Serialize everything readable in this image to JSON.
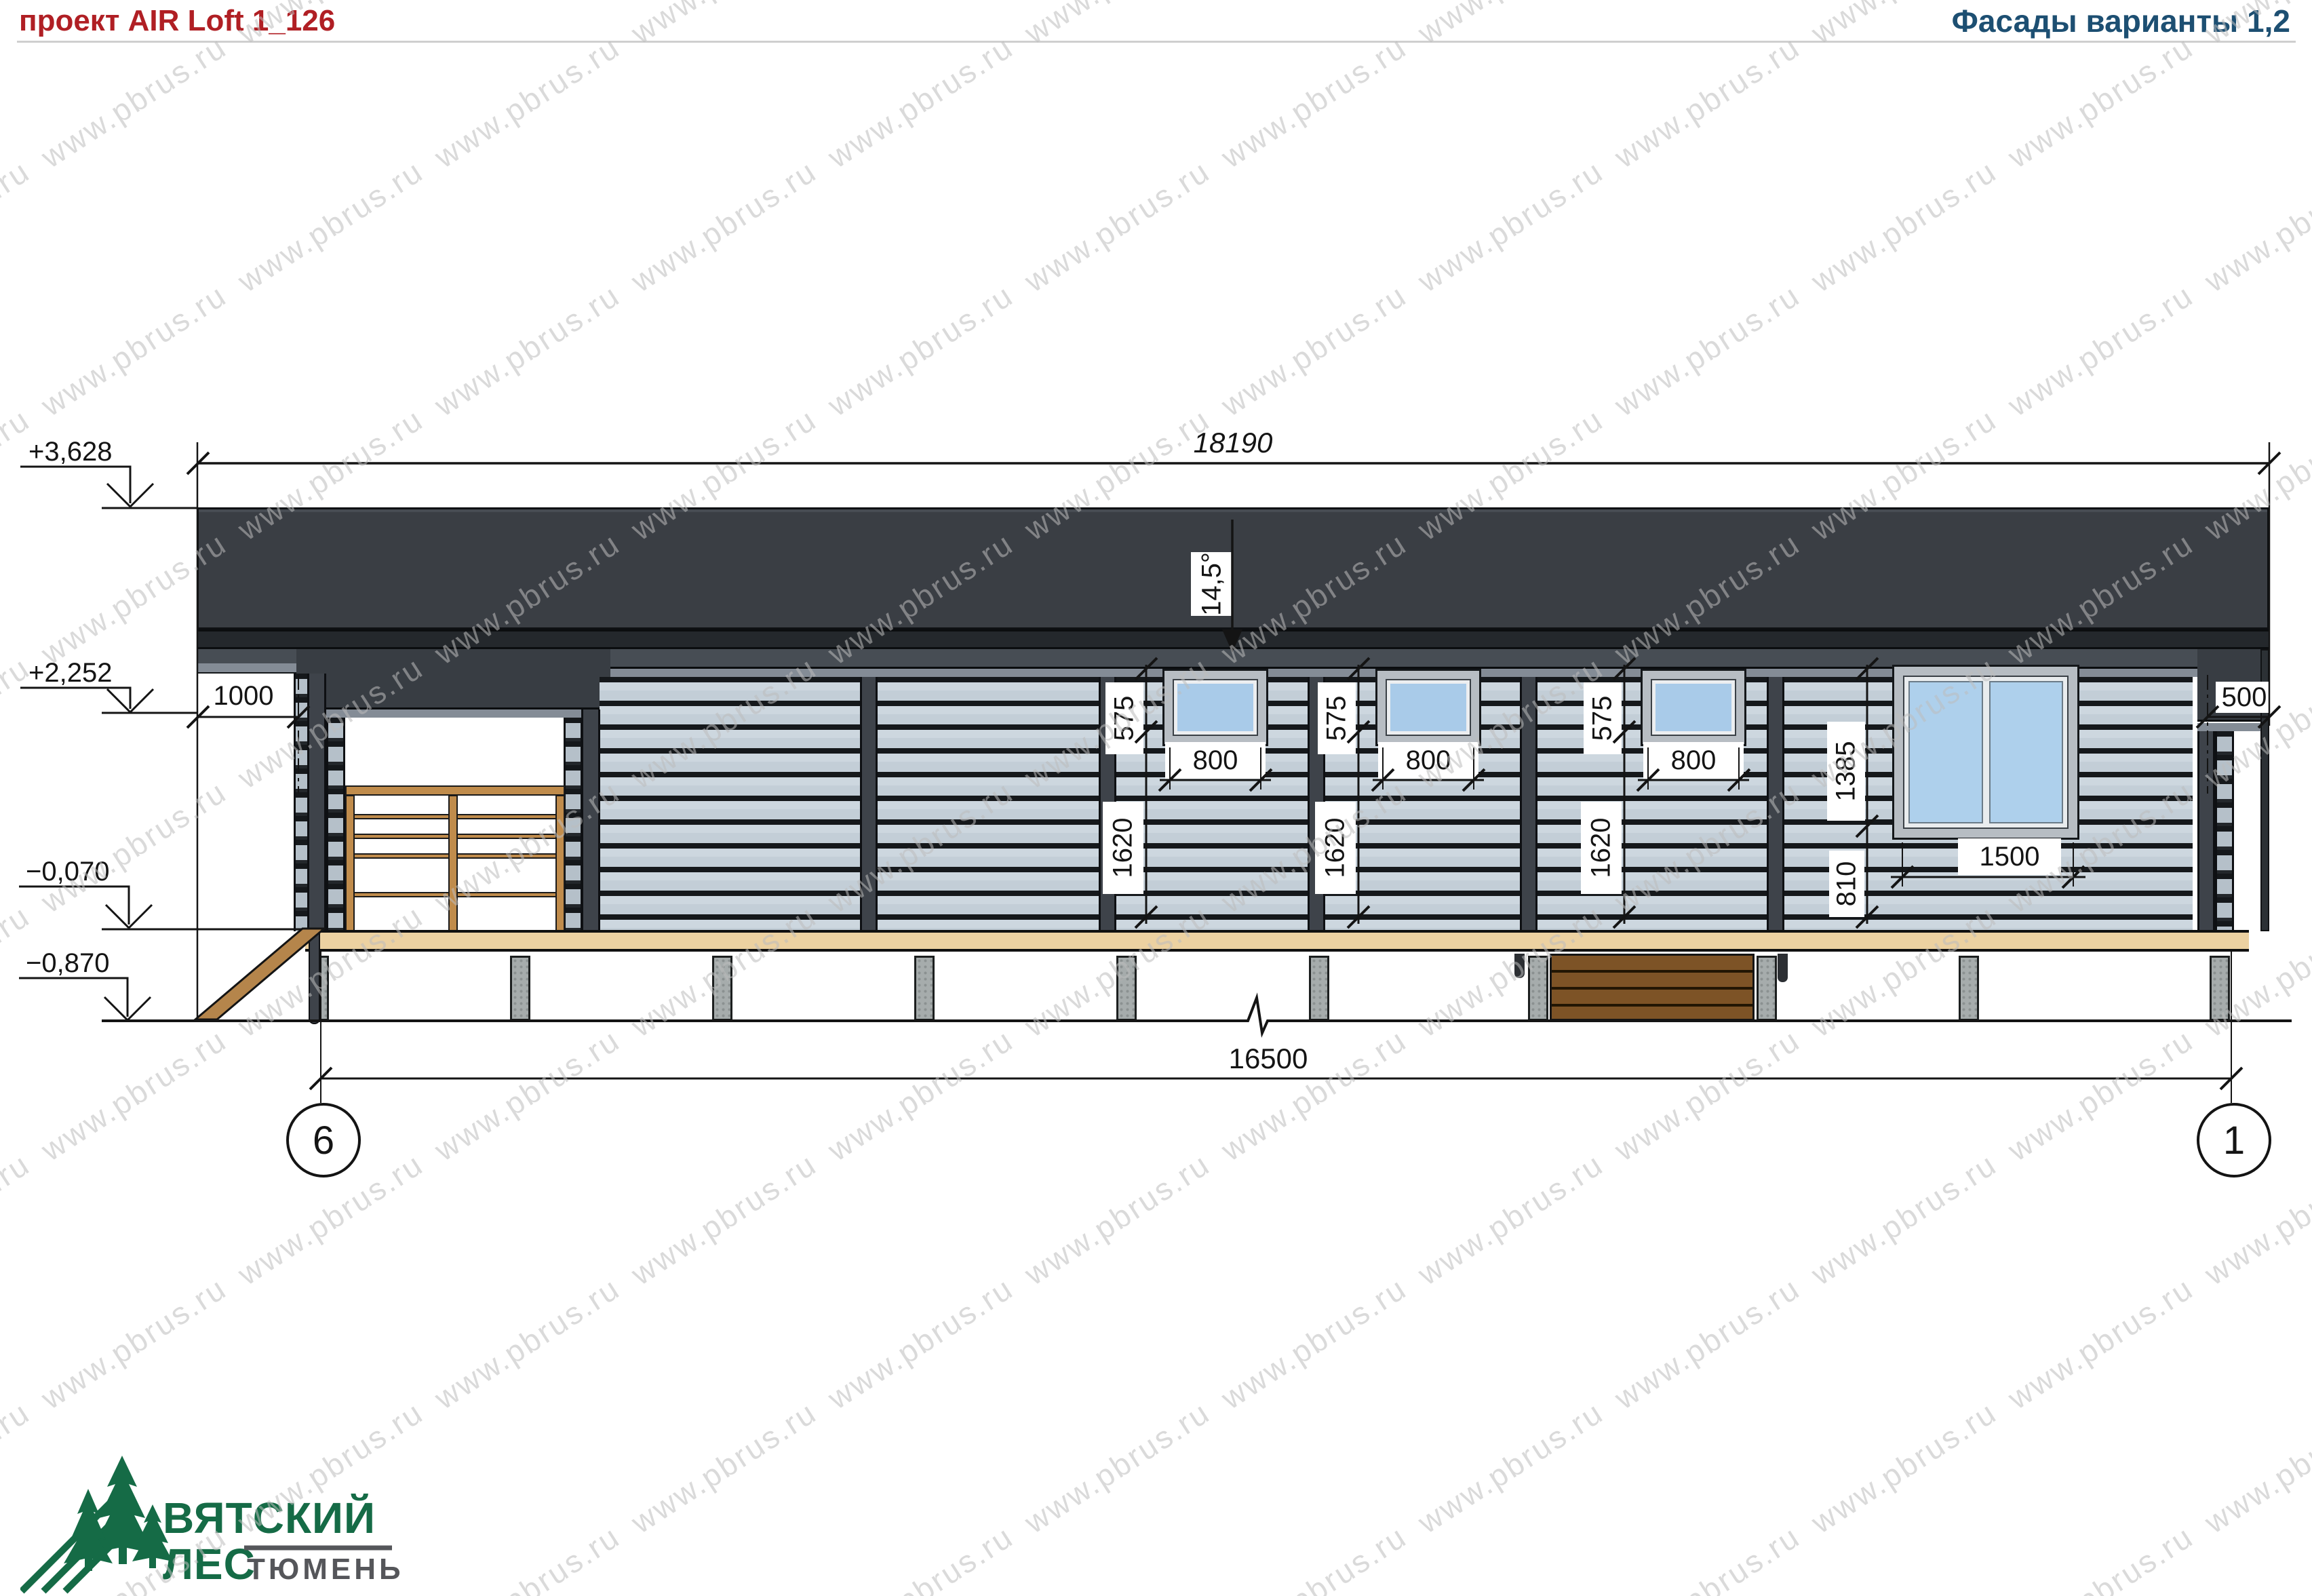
{
  "header": {
    "project_title": "проект AIR Loft 1_126",
    "sheet_title": "Фасады варианты 1,2"
  },
  "watermark": {
    "text": "www.pbrus.ru"
  },
  "dimensions": {
    "overall_width": "18190",
    "axis_span": "16500",
    "roof_slope": "14,5°",
    "left_overhang": "1000",
    "right_overhang": "500",
    "small_windows": [
      {
        "upper": "575",
        "lower": "1620",
        "width": "800"
      },
      {
        "upper": "575",
        "lower": "1620",
        "width": "800"
      },
      {
        "upper": "575",
        "lower": "1620",
        "width": "800"
      }
    ],
    "large_window": {
      "upper": "1385",
      "lower": "810",
      "width": "1500"
    }
  },
  "elevations": {
    "roof_top": "+3,628",
    "eave": "+2,252",
    "floor": "−0,070",
    "ground": "−0,870"
  },
  "axes": {
    "left": "6",
    "right": "1"
  },
  "logo": {
    "line1": "ВЯТСКИЙ",
    "line2": "ЛЕС",
    "line3": "ТЮМЕНЬ"
  },
  "colors": {
    "title_red": "#b01f24",
    "title_blue": "#1d4f72",
    "roof": "#3a3e44",
    "siding": "#cdd7df",
    "glass": "#a9cbe9",
    "deck": "#ecd1a1",
    "steps_brown": "#7d5326",
    "logo_green": "#156b46"
  }
}
